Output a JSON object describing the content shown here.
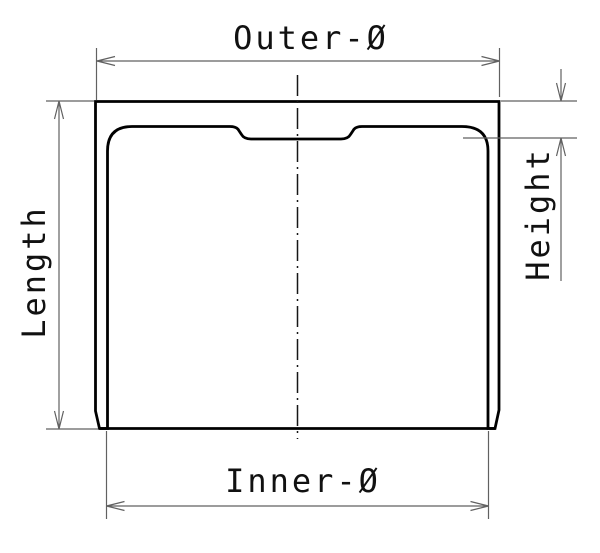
{
  "drawing": {
    "type": "technical-cross-section",
    "labels": {
      "outer_diameter": "Outer-Ø",
      "inner_diameter": "Inner-Ø",
      "length": "Length",
      "height": "Height"
    },
    "colors": {
      "background": "#ffffff",
      "part_outline": "#000000",
      "hatch_lines": "#222222",
      "dimension_lines": "#616161",
      "label_text": "#111111"
    }
  }
}
